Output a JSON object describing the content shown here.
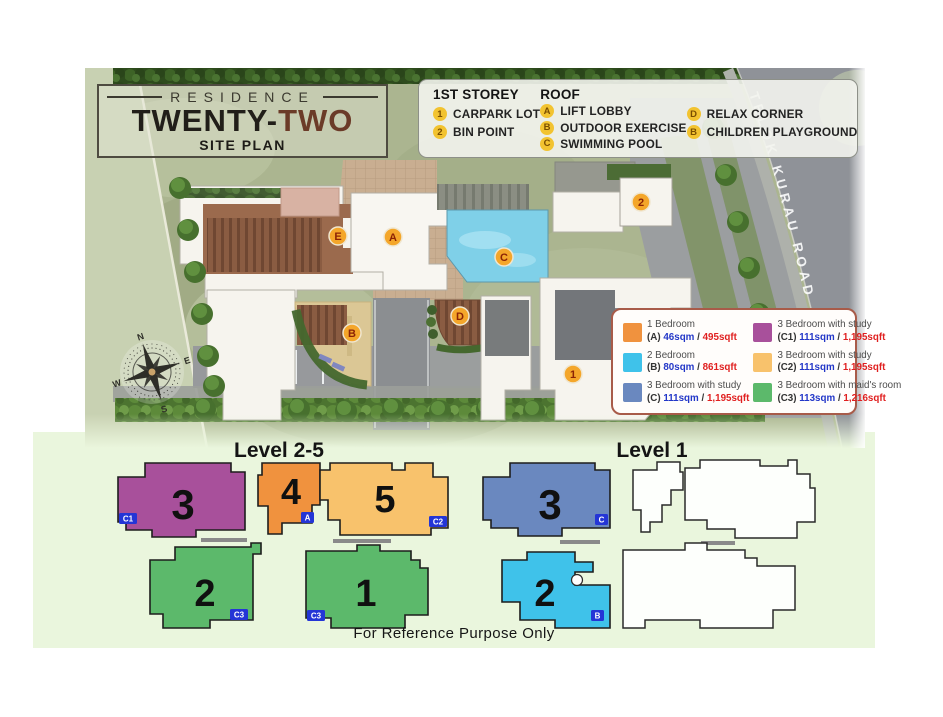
{
  "logo": {
    "brand": "RESIDENCE",
    "title_primary": "TWENTY-",
    "title_accent": "TWO",
    "subtitle": "SITE PLAN"
  },
  "amenity_legend": {
    "storey_title": "1ST STOREY",
    "storey_items": [
      {
        "badge": "1",
        "label": "CARPARK LOT"
      },
      {
        "badge": "2",
        "label": "BIN POINT"
      }
    ],
    "roof_title": "ROOF",
    "roof_items": [
      {
        "badge": "A",
        "label": "LIFT LOBBY"
      },
      {
        "badge": "B",
        "label": "OUTDOOR EXERCISE"
      },
      {
        "badge": "C",
        "label": "SWIMMING POOL"
      }
    ],
    "roof_items2": [
      {
        "badge": "D",
        "label": "RELAX CORNER"
      },
      {
        "badge": "B",
        "label": "CHILDREN PLAYGROUND"
      }
    ]
  },
  "road": {
    "label": "TELOK KURAU ROAD"
  },
  "compass": {
    "n": "N",
    "e": "E",
    "s": "S",
    "w": "W"
  },
  "site_markers": {
    "e": "E",
    "a": "A",
    "c": "C",
    "b": "B",
    "d": "D",
    "carpark": "1",
    "bin": "2"
  },
  "unit_legend": {
    "sep": "/",
    "items": [
      {
        "name": "1 Bedroom",
        "code": "(A)",
        "sqm": "46sqm",
        "sqft": "495sqft",
        "color": "#F0923E"
      },
      {
        "name": "3 Bedroom with study",
        "code": "(C1)",
        "sqm": "111sqm",
        "sqft": "1,195sqft",
        "color": "#A8509B"
      },
      {
        "name": "2 Bedroom",
        "code": "(B)",
        "sqm": "80sqm",
        "sqft": "861sqft",
        "color": "#3FC2EA"
      },
      {
        "name": "3 Bedroom with study",
        "code": "(C2)",
        "sqm": "111sqm",
        "sqft": "1,195sqft",
        "color": "#F8C26C"
      },
      {
        "name": "3 Bedroom with study",
        "code": "(C)",
        "sqm": "111sqm",
        "sqft": "1,195sqft",
        "color": "#6A88BF"
      },
      {
        "name": "3 Bedroom with maid's room",
        "code": "(C3)",
        "sqm": "113sqm",
        "sqft": "1,216sqft",
        "color": "#5CB96B"
      }
    ]
  },
  "floor_plans": {
    "left_title": "Level 2-5",
    "right_title": "Level 1",
    "left_units": [
      {
        "number": "3",
        "code": "C1"
      },
      {
        "number": "4",
        "code": "A"
      },
      {
        "number": "5",
        "code": "C2"
      },
      {
        "number": "2",
        "code": "C3"
      },
      {
        "number": "1",
        "code": "C3"
      }
    ],
    "right_units": [
      {
        "number": "3",
        "code": "C"
      },
      {
        "number": "2",
        "code": "B"
      }
    ]
  },
  "footer": {
    "disclaimer": "For Reference Purpose Only"
  },
  "colors": {
    "unit_a": "#F0923E",
    "unit_b": "#3FC2EA",
    "unit_c": "#6A88BF",
    "unit_c1": "#A8509B",
    "unit_c2": "#F8C26C",
    "unit_c3": "#5CB96B",
    "badge_blue": "#2435D6",
    "marker_orange": "#F4A62A",
    "sqm_blue": "#2337C8",
    "sqft_red": "#E02020",
    "brand_brown": "#6B3B28",
    "panel_green": "#EAF6DD"
  }
}
